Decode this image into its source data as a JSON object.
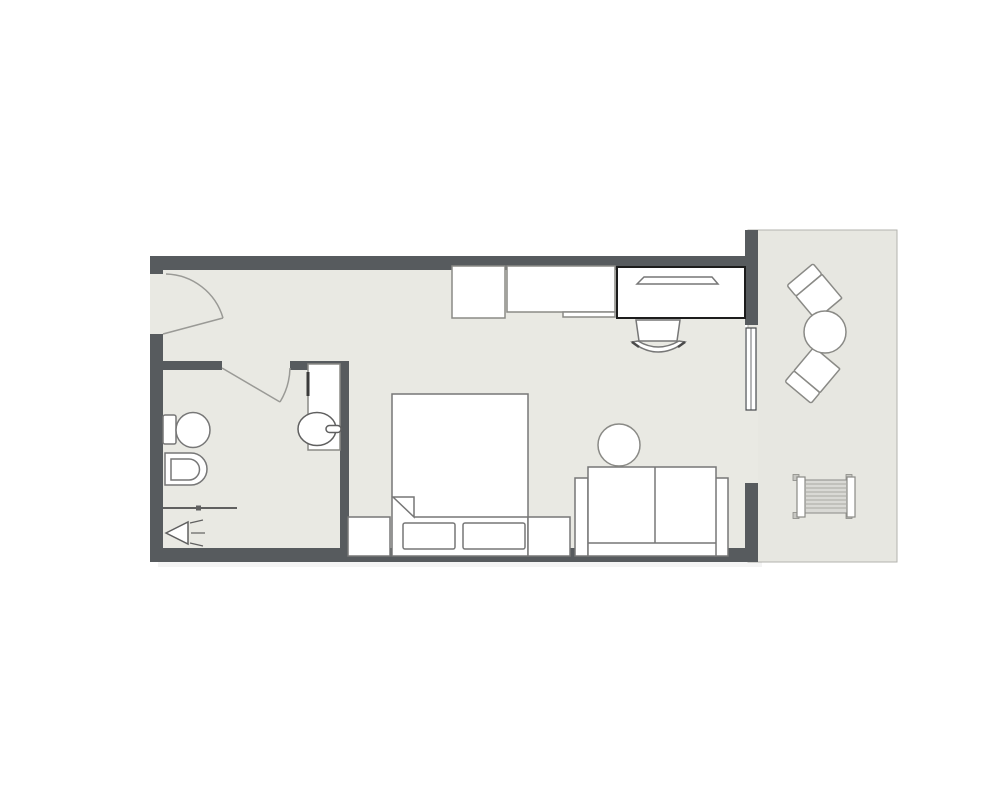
{
  "document": {
    "type": "floor-plan",
    "description": "Architectural floor plan of a studio hotel room with entrance, bathroom, bedroom-living area and balcony"
  },
  "colors": {
    "page_bg": "#ffffff",
    "wall": "#575b5e",
    "floor": "#e9e9e3",
    "balcony_floor": "#e7e7e1",
    "balcony_border": "#b3b3ae",
    "furn_fill": "#ffffff",
    "stroke_light": "#8a8a86",
    "stroke_med": "#777777",
    "stroke_dark": "#1c1c1c",
    "fixture_stroke": "#606060",
    "door_stroke": "#9a9a96",
    "window_stroke": "#46494c",
    "ac_body": "#d9d9d5",
    "ac_stripe": "#a9a9a4",
    "ac_foot": "#c7c7c2",
    "vanity_bar": "#3a3a3a"
  },
  "rooms": [
    {
      "id": "main-room",
      "label": "bedroom-living-area"
    },
    {
      "id": "bathroom",
      "label": "bathroom"
    },
    {
      "id": "balcony",
      "label": "balcony"
    }
  ],
  "inventory": {
    "main_room": [
      "entry-door",
      "cabinet",
      "tv-console",
      "desk",
      "tv",
      "desk-chair",
      "double-bed",
      "pillow-left",
      "pillow-right",
      "nightstand-left",
      "nightstand-right",
      "sofa",
      "round-side-table",
      "sliding-window"
    ],
    "bathroom": [
      "bathroom-door",
      "toilet",
      "bidet",
      "vanity-counter",
      "sink",
      "shower-screen",
      "shower-head"
    ],
    "balcony": [
      "round-table",
      "balcony-chair-top",
      "balcony-chair-bottom",
      "ac-unit"
    ]
  }
}
